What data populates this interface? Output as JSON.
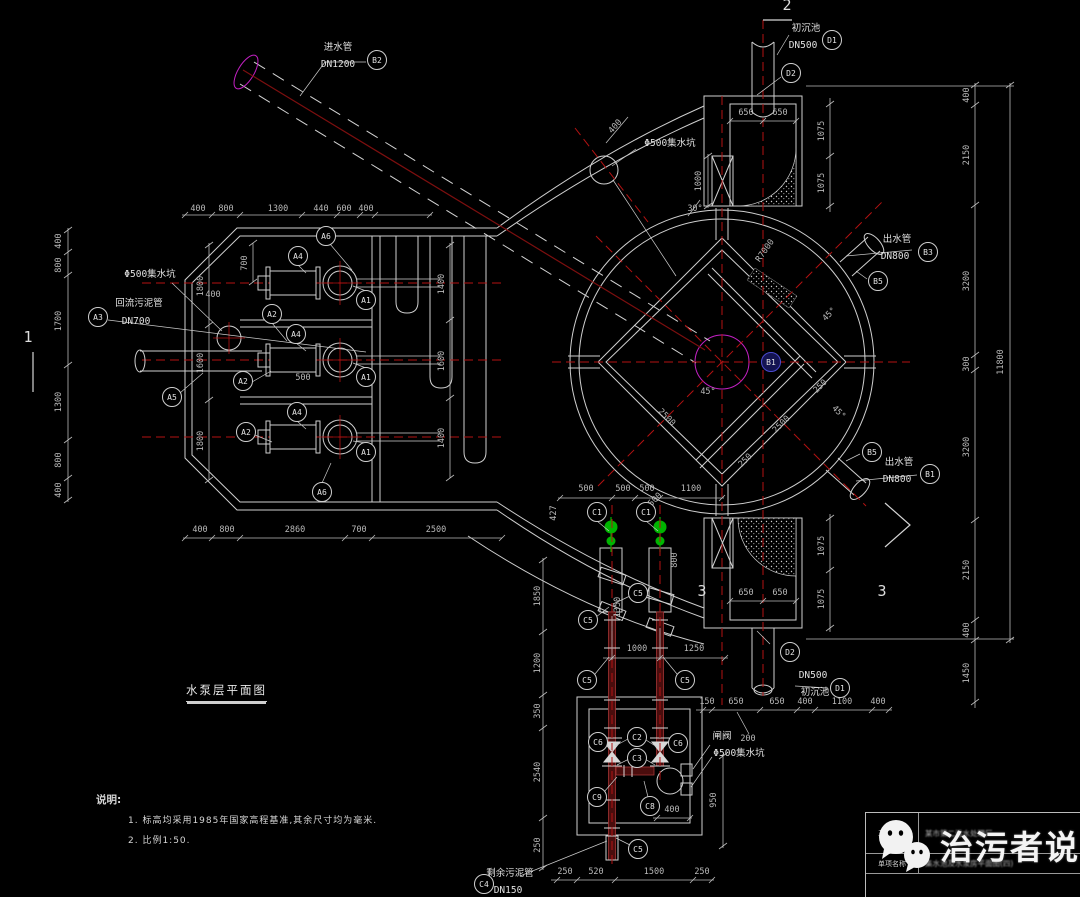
{
  "meta": {
    "drawing_title": "水泵层平面图"
  },
  "watermark": {
    "brand": "治污者说"
  },
  "title_block": {
    "rows": [
      {
        "label": "工程名称",
        "value": "某市第二污水处理厂"
      },
      {
        "label": "单项名称",
        "value": "集水池及水泵房平面图(四)"
      }
    ]
  },
  "notes": {
    "heading": "说明:",
    "items": [
      "1. 标高均采用1985年国家高程基准,其余尺寸均为毫米.",
      "2. 比例1:50."
    ]
  },
  "colors": {
    "line": "#cfcfcf",
    "dim": "#b9b9b9",
    "red": "#b31212",
    "maroon": "#4a0d0d",
    "maroon_edge": "#a33535",
    "green": "#00b400",
    "magenta": "#c320c3"
  },
  "drawing": {
    "dims": [
      [
        198,
        211,
        "400",
        0
      ],
      [
        226,
        211,
        "800",
        0
      ],
      [
        278,
        211,
        "1300",
        0
      ],
      [
        321,
        211,
        "440",
        0
      ],
      [
        344,
        211,
        "600",
        0
      ],
      [
        366,
        211,
        "400",
        0
      ],
      [
        61,
        241,
        "400",
        -90
      ],
      [
        61,
        265,
        "800",
        -90
      ],
      [
        61,
        321,
        "1700",
        -90
      ],
      [
        61,
        402,
        "1300",
        -90
      ],
      [
        61,
        460,
        "800",
        -90
      ],
      [
        61,
        490,
        "400",
        -90
      ],
      [
        200,
        532,
        "400",
        0
      ],
      [
        227,
        532,
        "800",
        0
      ],
      [
        295,
        532,
        "2860",
        0
      ],
      [
        359,
        532,
        "700",
        0
      ],
      [
        436,
        532,
        "2500",
        0
      ],
      [
        247,
        263,
        "700",
        -90
      ],
      [
        203,
        286,
        "1800",
        -90
      ],
      [
        203,
        363,
        "1600",
        -90
      ],
      [
        203,
        441,
        "1800",
        -90
      ],
      [
        444,
        284,
        "1400",
        -90
      ],
      [
        444,
        361,
        "1600",
        -90
      ],
      [
        444,
        438,
        "1400",
        -90
      ],
      [
        213,
        297,
        "400",
        0
      ],
      [
        303,
        380,
        "500",
        0
      ],
      [
        556,
        513,
        "427",
        -90
      ],
      [
        586,
        491,
        "500",
        0
      ],
      [
        623,
        491,
        "500",
        0
      ],
      [
        647,
        491,
        "500",
        0
      ],
      [
        691,
        491,
        "1100",
        0
      ],
      [
        677,
        560,
        "800",
        -90
      ],
      [
        620,
        607,
        "1350",
        -90
      ],
      [
        637,
        651,
        "1000",
        0
      ],
      [
        694,
        651,
        "1250",
        0
      ],
      [
        540,
        596,
        "1850",
        -90
      ],
      [
        540,
        663,
        "1200",
        -90
      ],
      [
        540,
        711,
        "350",
        -90
      ],
      [
        540,
        772,
        "2540",
        -90
      ],
      [
        540,
        845,
        "250",
        -90
      ],
      [
        672,
        812,
        "400",
        0
      ],
      [
        716,
        800,
        "950",
        -90
      ],
      [
        748,
        741,
        "200",
        0
      ],
      [
        565,
        874,
        "250",
        0
      ],
      [
        596,
        874,
        "520",
        0
      ],
      [
        654,
        874,
        "1500",
        0
      ],
      [
        702,
        874,
        "250",
        0
      ],
      [
        746,
        115,
        "650",
        0
      ],
      [
        780,
        115,
        "650",
        0
      ],
      [
        701,
        181,
        "1000",
        -90
      ],
      [
        824,
        131,
        "1075",
        -90
      ],
      [
        824,
        183,
        "1075",
        -90
      ],
      [
        617,
        128,
        "400",
        -48
      ],
      [
        695,
        211,
        "30°",
        0
      ],
      [
        746,
        595,
        "650",
        0
      ],
      [
        780,
        595,
        "650",
        0
      ],
      [
        824,
        546,
        "1075",
        -90
      ],
      [
        824,
        599,
        "1075",
        -90
      ],
      [
        707,
        704,
        "150",
        0
      ],
      [
        736,
        704,
        "650",
        0
      ],
      [
        777,
        704,
        "650",
        0
      ],
      [
        805,
        704,
        "400",
        0
      ],
      [
        842,
        704,
        "1100",
        0
      ],
      [
        878,
        704,
        "400",
        0
      ],
      [
        969,
        95,
        "400",
        -90
      ],
      [
        969,
        155,
        "2150",
        -90
      ],
      [
        969,
        281,
        "3200",
        -90
      ],
      [
        969,
        364,
        "300",
        -90
      ],
      [
        969,
        447,
        "3200",
        -90
      ],
      [
        969,
        570,
        "2150",
        -90
      ],
      [
        969,
        630,
        "400",
        -90
      ],
      [
        969,
        673,
        "1450",
        -90
      ],
      [
        1003,
        362,
        "11800",
        -90
      ],
      [
        767,
        252,
        "R7000",
        -55
      ],
      [
        831,
        316,
        "45°",
        -45
      ],
      [
        708,
        394,
        "45°",
        0
      ],
      [
        837,
        414,
        "45°",
        45
      ],
      [
        822,
        388,
        "250",
        -45
      ],
      [
        665,
        419,
        "2500",
        45
      ],
      [
        783,
        426,
        "2500",
        -45
      ],
      [
        655,
        503,
        "2500",
        -45
      ],
      [
        747,
        462,
        "250",
        -45
      ]
    ],
    "labels": [
      [
        338,
        50,
        "进水管"
      ],
      [
        338,
        67,
        "DN1200"
      ],
      [
        806,
        31,
        "初沉池"
      ],
      [
        803,
        48,
        "DN500"
      ],
      [
        150,
        277,
        "Φ500集水坑"
      ],
      [
        139,
        306,
        "回流污泥管"
      ],
      [
        136,
        324,
        "DN700"
      ],
      [
        670,
        146,
        "Φ500集水坑"
      ],
      [
        897,
        242,
        "出水管"
      ],
      [
        895,
        259,
        "DN800"
      ],
      [
        899,
        465,
        "出水管"
      ],
      [
        897,
        482,
        "DN800"
      ],
      [
        813,
        678,
        "DN500"
      ],
      [
        815,
        695,
        "初沉池"
      ],
      [
        722,
        739,
        "闸阀"
      ],
      [
        739,
        756,
        "Φ500集水坑"
      ],
      [
        510,
        876,
        "剩余污泥管"
      ],
      [
        508,
        893,
        "DN150"
      ]
    ],
    "tags": [
      [
        377,
        60,
        "B2"
      ],
      [
        832,
        40,
        "D1"
      ],
      [
        791,
        73,
        "D2"
      ],
      [
        326,
        236,
        "A6"
      ],
      [
        298,
        256,
        "A4"
      ],
      [
        366,
        300,
        "A1"
      ],
      [
        272,
        314,
        "A2"
      ],
      [
        296,
        334,
        "A4"
      ],
      [
        366,
        377,
        "A1"
      ],
      [
        243,
        381,
        "A2"
      ],
      [
        297,
        412,
        "A4"
      ],
      [
        246,
        432,
        "A2"
      ],
      [
        366,
        452,
        "A1"
      ],
      [
        322,
        492,
        "A6"
      ],
      [
        98,
        317,
        "A3"
      ],
      [
        172,
        397,
        "A5"
      ],
      [
        928,
        252,
        "B3"
      ],
      [
        878,
        281,
        "B5"
      ],
      [
        872,
        452,
        "B5"
      ],
      [
        930,
        474,
        "B1"
      ],
      [
        597,
        512,
        "C1"
      ],
      [
        646,
        512,
        "C1"
      ],
      [
        638,
        593,
        "C5"
      ],
      [
        588,
        620,
        "C5"
      ],
      [
        587,
        680,
        "C5"
      ],
      [
        685,
        680,
        "C5"
      ],
      [
        598,
        742,
        "C6"
      ],
      [
        637,
        737,
        "C2"
      ],
      [
        678,
        743,
        "C6"
      ],
      [
        637,
        758,
        "C3"
      ],
      [
        597,
        797,
        "C9"
      ],
      [
        650,
        806,
        "C8"
      ],
      [
        638,
        849,
        "C5"
      ],
      [
        484,
        884,
        "C4"
      ],
      [
        790,
        652,
        "D2"
      ],
      [
        840,
        688,
        "D1"
      ]
    ],
    "center_tag": {
      "x": 771,
      "y": 362,
      "label": "B1"
    },
    "sections": [
      [
        787,
        10,
        "2"
      ],
      [
        28,
        342,
        "1"
      ],
      [
        702,
        596,
        "3"
      ],
      [
        882,
        596,
        "3"
      ]
    ]
  }
}
